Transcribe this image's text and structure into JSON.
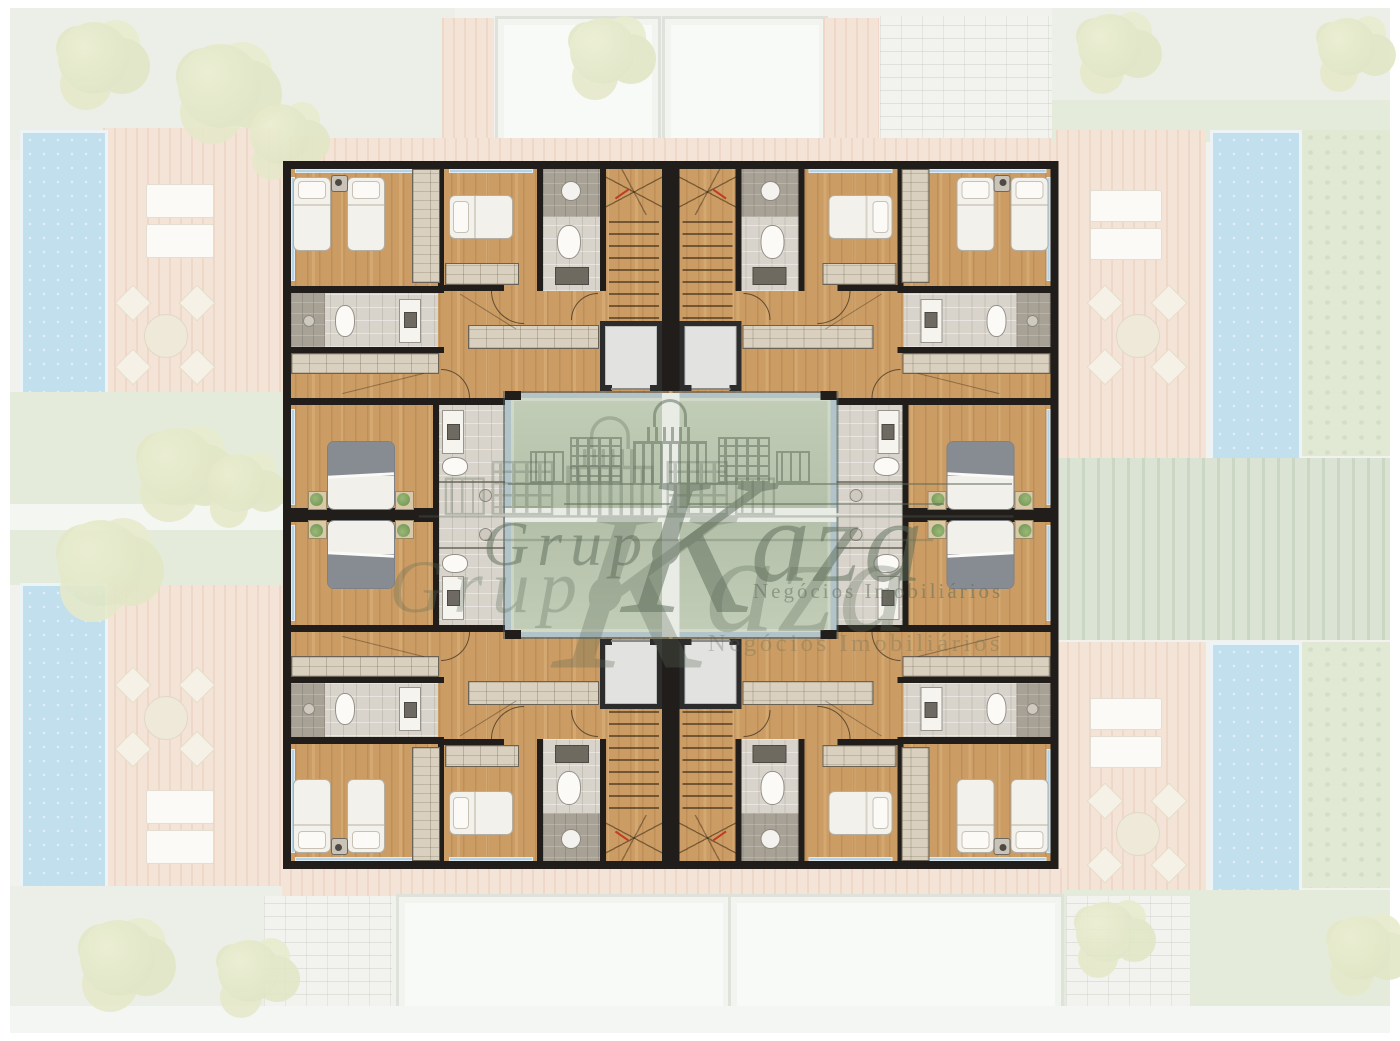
{
  "watermark": {
    "prefix": "Grupo",
    "brand": "Kaza",
    "brand_initial": "K",
    "brand_rest": "aza",
    "tagline": "Negócios Imobiliários",
    "color": "#5c6b59"
  },
  "palette": {
    "wood_floor": "#cb9c63",
    "wall": "#201d1a",
    "window_glazing": "#b5d2e4",
    "courtyard_glass": "#b9c4ae",
    "tile_light": "#d8d4cb",
    "tile_dark": "#a8a296",
    "closet": "#d9d0bf",
    "elevator_cab": "#e2e2e0",
    "stair_mark_red": "#c23b22",
    "pool": "#c2dfee",
    "deck": "#f4e3d7",
    "lawn": "#e1e9d5",
    "hedge": "#dbe4d4",
    "tree": "#e5e9c9"
  }
}
